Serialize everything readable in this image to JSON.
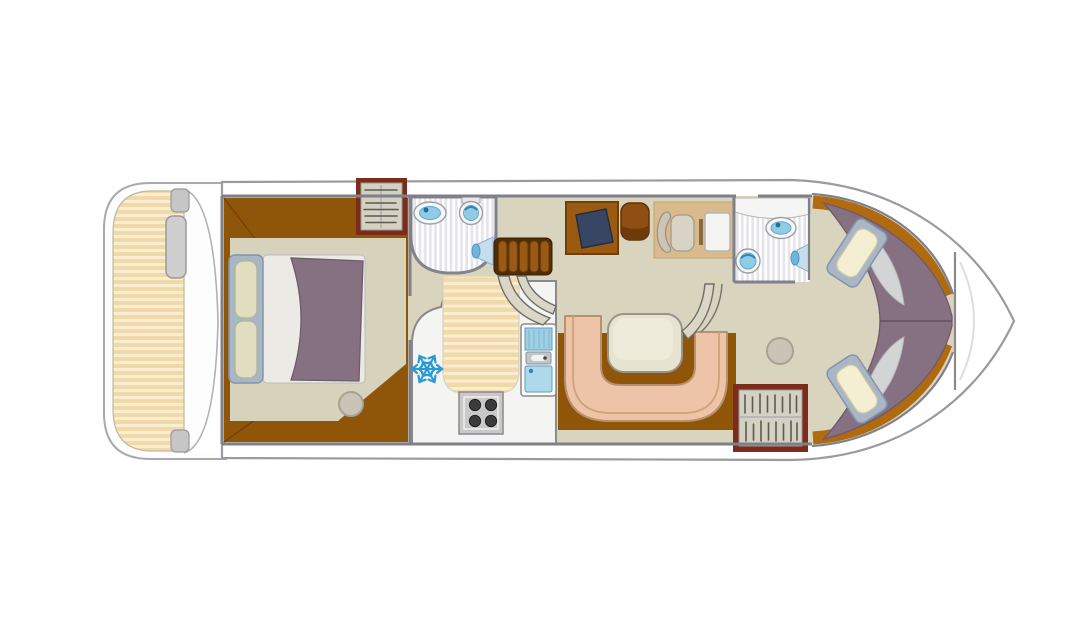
{
  "figure": {
    "kind": "boat-floor-plan",
    "orientation": "bow-right",
    "rooms": [
      {
        "id": "stern-deck"
      },
      {
        "id": "aft-cabin"
      },
      {
        "id": "aft-bathroom"
      },
      {
        "id": "galley"
      },
      {
        "id": "companionway-stairs"
      },
      {
        "id": "helm-station"
      },
      {
        "id": "dinette"
      },
      {
        "id": "forward-bathroom"
      },
      {
        "id": "bow-cabin"
      },
      {
        "id": "bow-deck"
      }
    ],
    "icons": {
      "fridge": "snowflake-icon",
      "bathroom_fixtures": [
        "washbasin-icon",
        "toilet-icon",
        "shower-head-icon"
      ],
      "galley_fixtures": [
        "stove-burners-icon",
        "kitchen-sink-icon"
      ],
      "storage": "coat-hanger-icon",
      "beds": [
        "double-bed",
        "v-berth-single-bed",
        "v-berth-single-bed"
      ]
    }
  },
  "colors": {
    "canvas_bg": "#ffffff",
    "hull_fill": "#ffffff",
    "hull_stroke": "#9a9aa2",
    "wall": "#80808a",
    "saloon_floor": "#d8d4be",
    "cabin_floor": "#d6d2bc",
    "wood_floor": "#8f5509",
    "wood_trim": "#b06a10",
    "deck_stripe_a": "#f2d9a8",
    "deck_stripe_b": "#f9edd4",
    "tile_a": "#ffffff",
    "tile_b": "#e4e4ea",
    "fixture_rim": "#f7f7f7",
    "fixture_blue": "#90cce6",
    "fixture_blue_dark": "#2f85b3",
    "mattress_purple": "#867183",
    "sheet_white": "#eceae5",
    "sheet_gray": "#d2d4d6",
    "bed_frame": "#a9b6c6",
    "pillow_beige": "#e2dcc0",
    "pillow_cream": "#f4eed2",
    "wardrobe_frame": "#7d2c1c",
    "wardrobe_interior": "#d4d0c2",
    "hanger": "#5a5a52",
    "counter": "#f4f4f2",
    "stove_gray": "#c9c9c9",
    "burner": "#3c3c3c",
    "sink_blue": "#aed9ea",
    "drainer_blue": "#9fcfe4",
    "snowflake": "#2a9ad4",
    "stairs_dark": "#4f2e06",
    "stairs_slat": "#9a5a16",
    "rail": "#dbd7c7",
    "desk_wood": "#9a5a10",
    "chart_navy": "#394663",
    "stool_wood": "#8f4e12",
    "helm_mat": "#d9ba8d",
    "seat_beige": "#d9d3c5",
    "seat_back": "#ccc5b5",
    "console": "#f3f3f1",
    "bench_salmon": "#eec4a9",
    "bench_outline": "#b8916e",
    "table_cream": "#e7e3d1",
    "stool_gray": "#c9c5b6",
    "deck_seat": "#cfcfcf"
  }
}
